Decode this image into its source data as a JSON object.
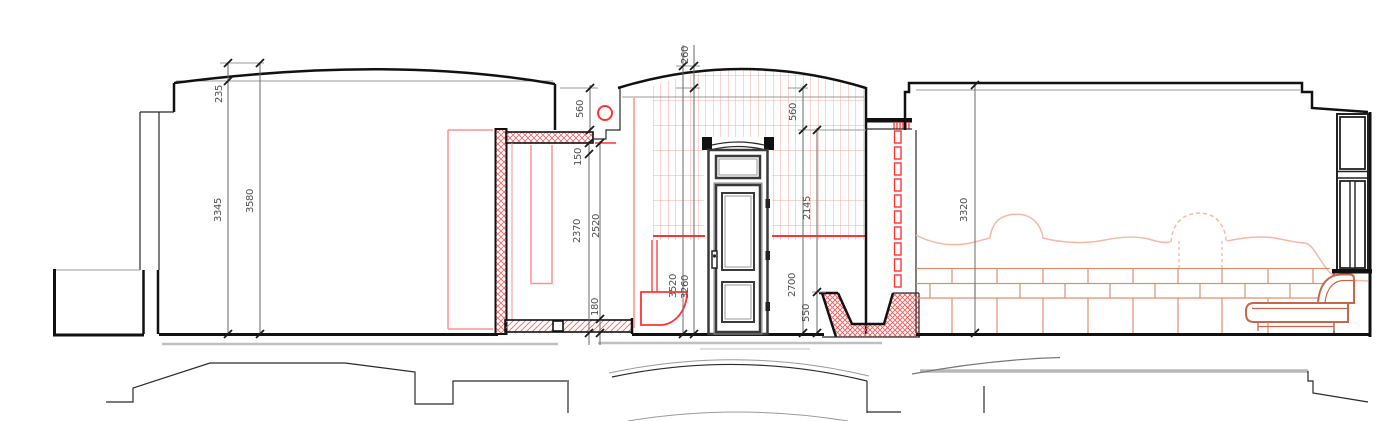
{
  "drawing": {
    "kind": "architectural-section-elevation",
    "dims": {
      "left_roof_rise": "235",
      "left_wall_height": "3345",
      "left_total_height": "3580",
      "closet_parapet": "560",
      "closet_ceiling_slab": "150",
      "closet_clear_height": "2370",
      "closet_total_height": "2520",
      "closet_floor_slab": "180",
      "vest_dome_rise": "260",
      "vest_total_height": "3520",
      "vest_eave_height": "3260",
      "vest_parapet": "560",
      "vest_opening_height": "2145",
      "vest_wall_height": "2700",
      "vest_basin_height": "550",
      "right_room_height": "3320"
    },
    "colors": {
      "outline_black": "#111111",
      "accent_red": "#ff3333",
      "light_red": "#f7a8a8",
      "salmon_wave": "#f7b8a4",
      "terracotta_sofa": "#c96548",
      "grid_orange": "#dd9070",
      "dim_text": "#4f4f4f",
      "slab_grey": "#c0c0c0"
    }
  }
}
